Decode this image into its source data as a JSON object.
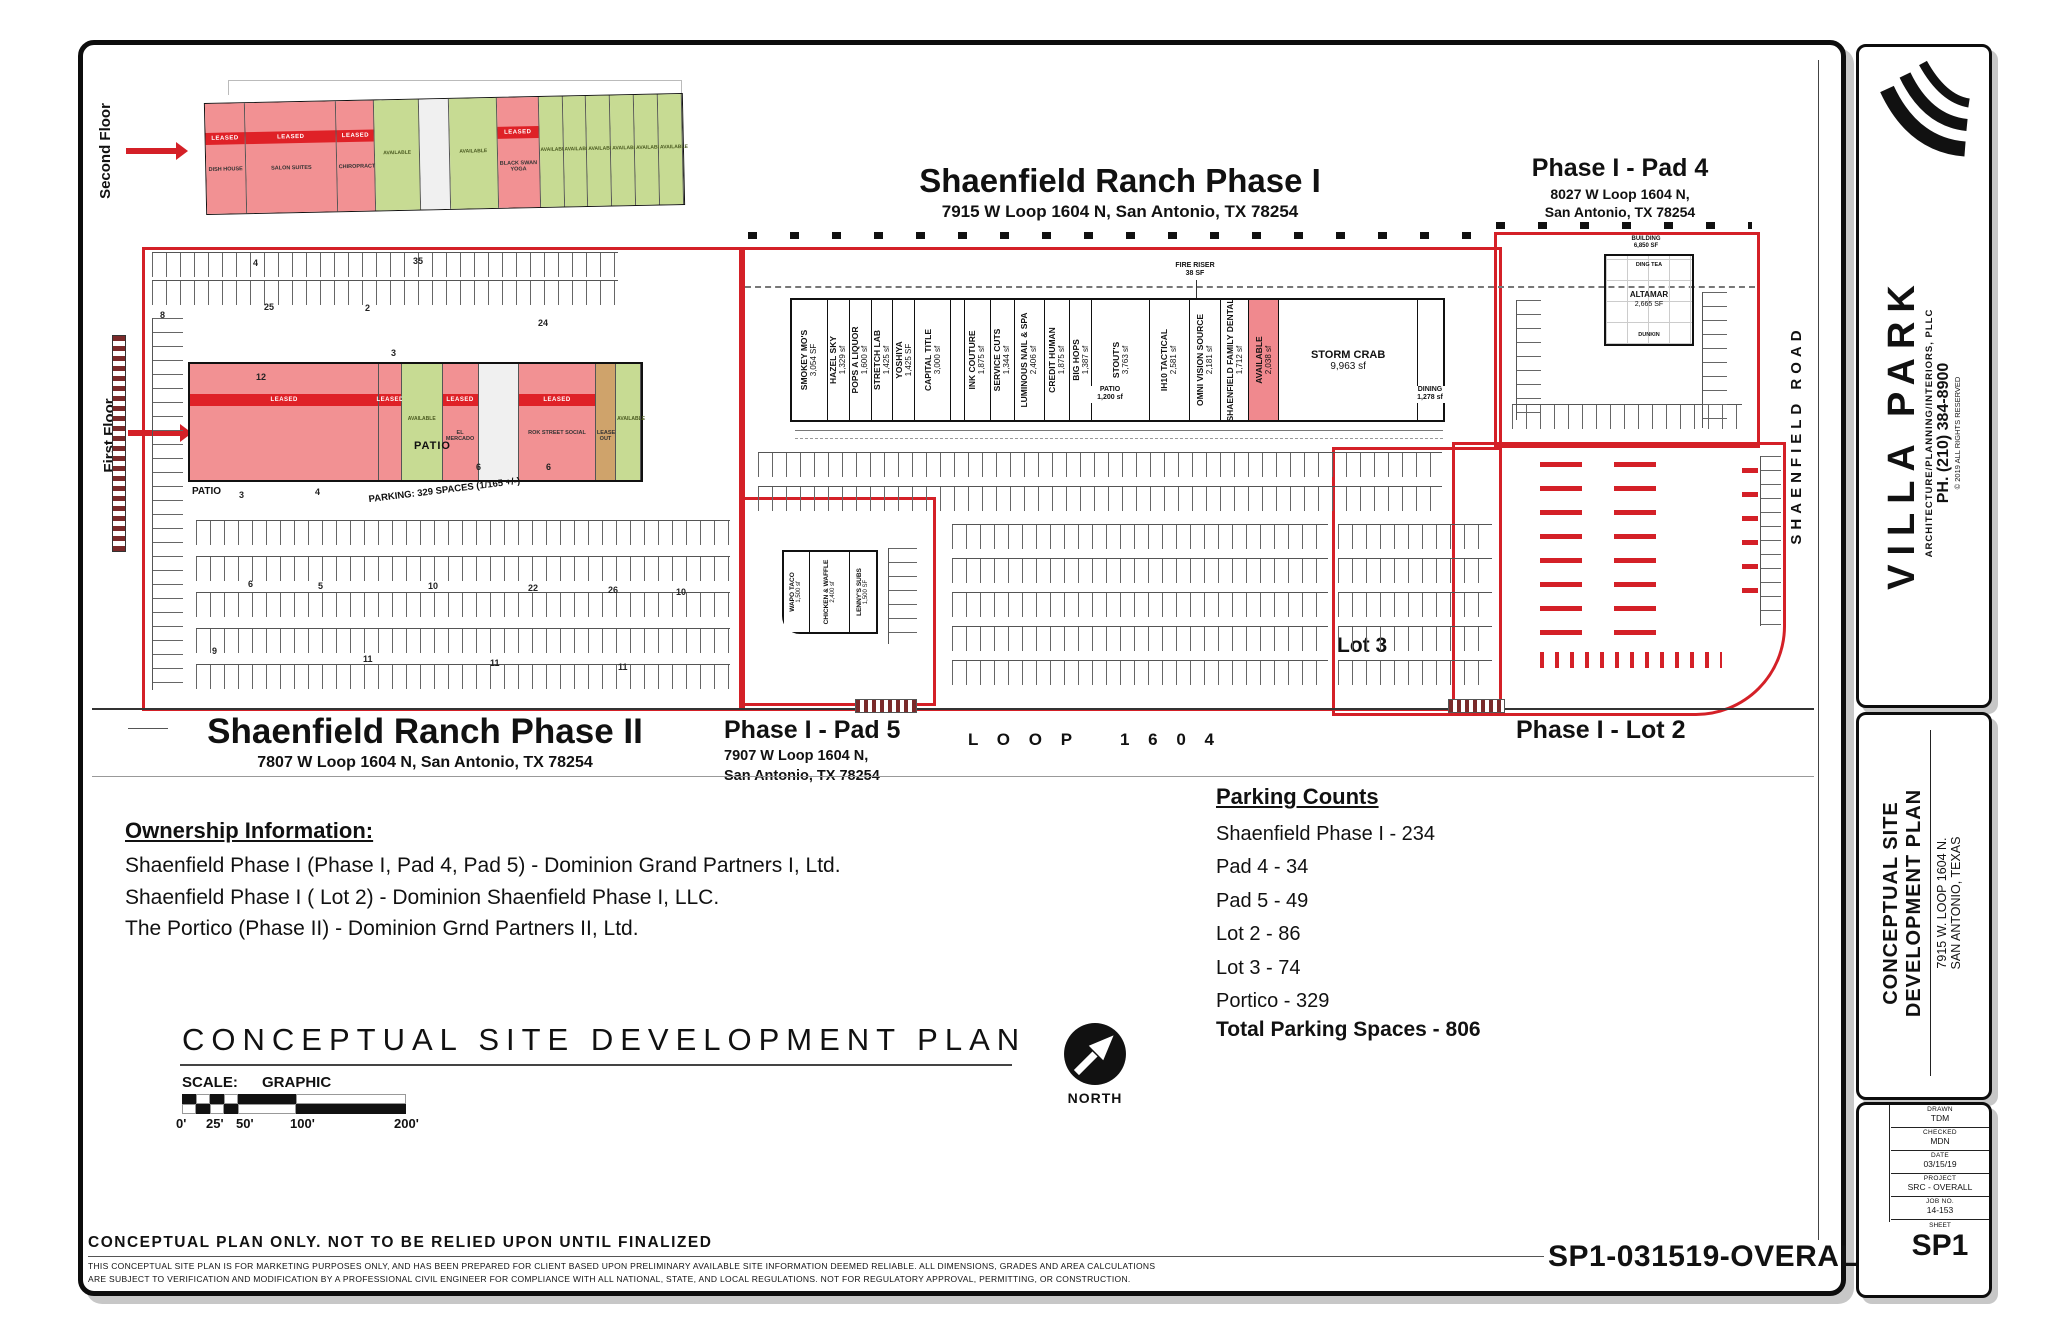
{
  "colors": {
    "boundary_red": "#d42027",
    "leased_fill": "#f29193",
    "leased_band": "#df2127",
    "available_green": "#c7db93",
    "lease_out_tan": "#cfa36b"
  },
  "labels": {
    "phase1_title": "Shaenfield Ranch Phase I",
    "phase1_address": "7915 W Loop 1604 N, San Antonio, TX 78254",
    "pad4_title": "Phase I - Pad 4",
    "pad4_address1": "8027 W Loop 1604 N,",
    "pad4_address2": "San Antonio, TX 78254",
    "phase2_title": "Shaenfield Ranch Phase II",
    "phase2_address": "7807 W Loop 1604 N, San Antonio, TX 78254",
    "pad5_title": "Phase I - Pad 5",
    "pad5_address1": "7907 W Loop 1604 N,",
    "pad5_address2": "San Antonio, TX 78254",
    "lot2": "Phase I - Lot 2",
    "lot3": "Lot 3",
    "loop_word": "L O O P",
    "loop_num": "1 6 0 4",
    "road": "SHAENFIELD   ROAD",
    "second_floor": "Second Floor",
    "first_floor": "First Floor",
    "parking_note": "PARKING: 329 SPACES (1/165 +/-)",
    "patio": "PATIO",
    "patio_sf": "1,200 sf",
    "dining": "DINING",
    "dining_sf": "1,278 sf",
    "fire_riser": "FIRE RISER",
    "fire_riser_sf": "38 SF",
    "pad4_building": "BUILDING",
    "pad4_building_sf": "6,850 SF",
    "leased": "LEASED"
  },
  "phase1_units": [
    {
      "name": "SMOKEY MO'S",
      "sf": "3,054 SF"
    },
    {
      "name": "HAZEL SKY",
      "sf": "1,329 sf"
    },
    {
      "name": "POPS A LIQUOR",
      "sf": "1,600 sf"
    },
    {
      "name": "STRETCH LAB",
      "sf": "1,425 sf"
    },
    {
      "name": "YOSHIYA",
      "sf": "1,425 SF"
    },
    {
      "name": "CAPITAL TITLE",
      "sf": "3,000 sf"
    },
    {
      "name": "INK COUTURE",
      "sf": "1,875 sf"
    },
    {
      "name": "SERVICE CUTS",
      "sf": "1,344 sf"
    },
    {
      "name": "LUMINOUS NAIL & SPA",
      "sf": "2,406 sf"
    },
    {
      "name": "CREDIT HUMAN",
      "sf": "1,875 sf"
    },
    {
      "name": "BIG HOPS",
      "sf": "1,387 sf"
    },
    {
      "name": "STOUT'S",
      "sf": "3,763 sf"
    },
    {
      "name": "IH10 TACTICAL",
      "sf": "2,581 sf"
    },
    {
      "name": "OMNI VISION SOURCE",
      "sf": "2,181 sf"
    },
    {
      "name": "SHAENFIELD FAMILY DENTAL",
      "sf": "1,712 sf"
    },
    {
      "name": "AVAILABLE",
      "sf": "2,038 sf",
      "available": true
    },
    {
      "name": "STORM CRAB",
      "sf": "9,963 sf"
    }
  ],
  "pad5_units": [
    {
      "name": "WAPO TACO",
      "sf": "1,500 sf"
    },
    {
      "name": "CHICKEN & WAFFLE",
      "sf": "2,400 sf"
    },
    {
      "name": "LENNY'S SUBS",
      "sf": "1,500 SF"
    }
  ],
  "pad4_unit": {
    "name": "ALTAMAR",
    "sf": "2,665 SF",
    "top": "DING TEA",
    "bottom": "DUNKIN"
  },
  "second_floor_units": [
    {
      "type": "leased",
      "name": "DISH HOUSE"
    },
    {
      "type": "leased",
      "name": "SALON SUITES"
    },
    {
      "type": "leased",
      "name": "CHIROPRACTOR"
    },
    {
      "type": "available",
      "name": "AVAILABLE"
    },
    {
      "type": "core",
      "name": ""
    },
    {
      "type": "available",
      "name": "AVAILABLE"
    },
    {
      "type": "leased",
      "name": "BLACK SWAN YOGA"
    },
    {
      "type": "available",
      "name": "AVAILABLE"
    },
    {
      "type": "available",
      "name": "AVAILABLE"
    },
    {
      "type": "available",
      "name": "AVAILABLE"
    },
    {
      "type": "available",
      "name": "AVAILABLE"
    },
    {
      "type": "available",
      "name": "AVAILABLE"
    },
    {
      "type": "available",
      "name": "AVAILABLE"
    }
  ],
  "first_floor_units": [
    {
      "type": "leased",
      "name": ""
    },
    {
      "type": "leased",
      "name": ""
    },
    {
      "type": "available",
      "name": "AVAILABLE"
    },
    {
      "type": "leased",
      "name": "EL MERCADO"
    },
    {
      "type": "core",
      "name": ""
    },
    {
      "type": "leased",
      "name": "ROK STREET SOCIAL"
    },
    {
      "type": "tan",
      "name": "LEASE OUT"
    },
    {
      "type": "available",
      "name": "AVAILABLE"
    }
  ],
  "row_numbers": [
    "4",
    "35",
    "25",
    "8",
    "2",
    "12",
    "3",
    "24",
    "9",
    "11",
    "11",
    "11",
    "3",
    "4",
    "6",
    "6",
    "10",
    "22",
    "26",
    "10",
    "5",
    "6"
  ],
  "ownership": {
    "title": "Ownership Information:",
    "lines": [
      "Shaenfield Phase I (Phase I, Pad 4, Pad 5) - Dominion Grand Partners I, Ltd.",
      "Shaenfield Phase I ( Lot 2) - Dominion Shaenfield Phase I, LLC.",
      "The Portico (Phase II) - Dominion Grnd Partners II, Ltd."
    ]
  },
  "parking_counts": {
    "title": "Parking Counts",
    "lines": [
      "Shaenfield Phase I - 234",
      "Pad 4 - 34",
      "Pad 5 - 49",
      "Lot 2 - 86",
      "Lot 3 - 74",
      "Portico - 329"
    ],
    "total": "Total Parking Spaces - 806"
  },
  "plan_block": {
    "title": "CONCEPTUAL SITE DEVELOPMENT PLAN",
    "scale_label": "SCALE:",
    "scale_type": "GRAPHIC",
    "ticks": [
      "0'",
      "25'",
      "50'",
      "100'",
      "200'"
    ],
    "north": "NORTH"
  },
  "disclaimer": {
    "title": "CONCEPTUAL PLAN ONLY.   NOT TO BE RELIED UPON UNTIL FINALIZED",
    "line1": "THIS CONCEPTUAL SITE PLAN IS FOR MARKETING PURPOSES ONLY, AND HAS BEEN PREPARED FOR CLIENT BASED UPON PRELIMINARY AVAILABLE SITE INFORMATION DEEMED RELIABLE.  ALL DIMENSIONS, GRADES AND AREA CALCULATIONS",
    "line2": "ARE SUBJECT TO VERIFICATION AND MODIFICATION BY A PROFESSIONAL CIVIL ENGINEER FOR COMPLIANCE WITH ALL NATIONAL, STATE, AND LOCAL REGULATIONS.  NOT FOR REGULATORY APPROVAL, PERMITTING, OR CONSTRUCTION."
  },
  "stamp": "SP1-031519-OVERALL",
  "titleblock": {
    "firm": "VILLA PARK",
    "firm_sub": "ARCHITECTURE/PLANNING/INTERIORS, PLLC",
    "phone": "PH. (210) 384-8900",
    "copyright": "© 2019 ALL RIGHTS RESERVED",
    "project_line1": "CONCEPTUAL SITE",
    "project_line2": "DEVELOPMENT PLAN",
    "address_line1": "7915 W. LOOP 1604 N.",
    "address_line2": "SAN ANTONIO, TEXAS",
    "rows": [
      {
        "label": "DRAWN",
        "value": "TDM"
      },
      {
        "label": "CHECKED",
        "value": "MDN"
      },
      {
        "label": "DATE",
        "value": "03/15/19"
      },
      {
        "label": "PROJECT",
        "value": "SRC - OVERALL"
      },
      {
        "label": "JOB NO.",
        "value": "14-153"
      }
    ],
    "sheet_label": "SHEET",
    "sheet": "SP1"
  }
}
